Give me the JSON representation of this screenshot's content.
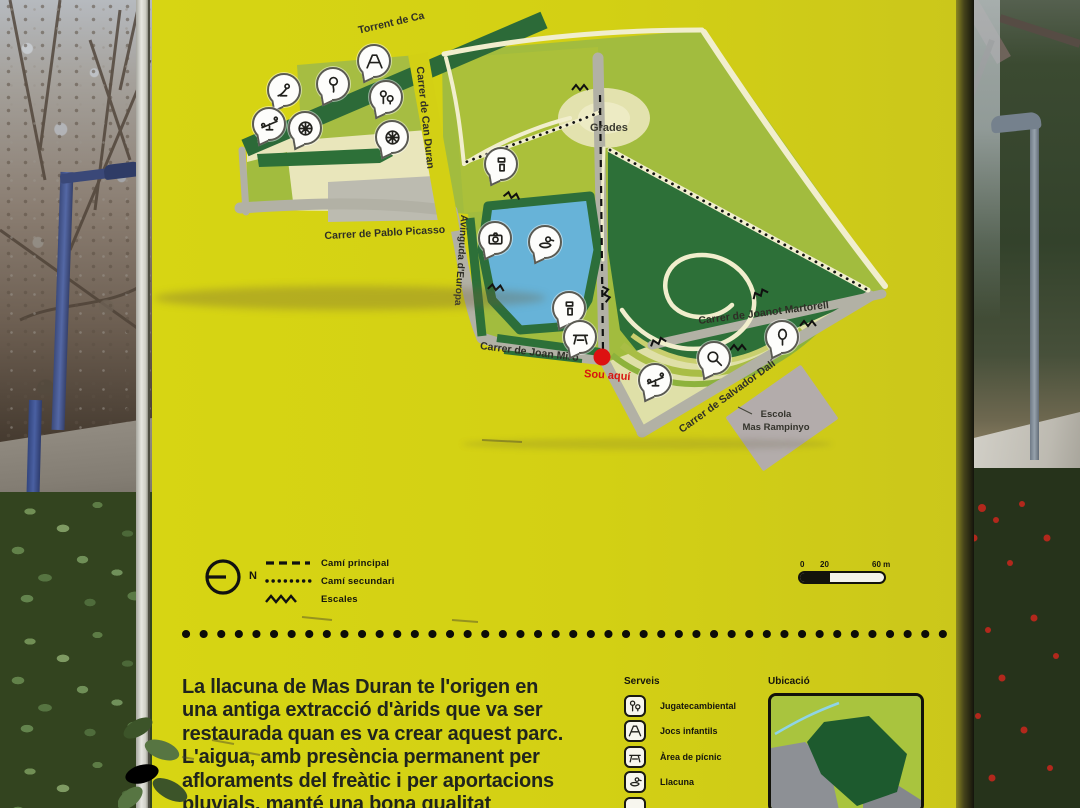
{
  "scene": {
    "description": "Photograph of a yellow park information panel (llacuna de Mas Duran) standing on a path between bare winter trees, lamp posts and bushes with red berries"
  },
  "colors": {
    "sign_yellow": "#d3d014",
    "map_light_green": "#a2bc3e",
    "map_dark_green": "#2d7038",
    "lake_blue": "#67b3d8",
    "path_cream": "#f1eecd",
    "street_gray": "#b2b1a5",
    "you_are_here_red": "#dd1111",
    "label_ink": "#2e2e26"
  },
  "sign": {
    "map": {
      "labels": {
        "torrent": "Torrent de Ca",
        "can_duran": "Carrer de Can Duran",
        "pablo_picasso": "Carrer de Pablo Picasso",
        "avinguda_europa": "Avinguda d'Europa",
        "grades": "Grades",
        "joanot_martorell": "Carrer de Joanot Martorell",
        "joan_miro": "Carrer de Joan Miró",
        "salvador_dali": "Carrer de Salvador Dalí",
        "escola_line1": "Escola",
        "escola_line2": "Mas Rampinyo",
        "you_are_here": "Sou aquí"
      },
      "markers": [
        {
          "icon": "bird-icon",
          "x": 132,
          "y": 90
        },
        {
          "icon": "swings-icon",
          "x": 222,
          "y": 61
        },
        {
          "icon": "balloon-icon",
          "x": 181,
          "y": 84
        },
        {
          "icon": "jugateca-icon",
          "x": 234,
          "y": 97
        },
        {
          "icon": "seesaw-icon",
          "x": 117,
          "y": 124
        },
        {
          "icon": "wheel-icon",
          "x": 153,
          "y": 128
        },
        {
          "icon": "wheel-icon",
          "x": 240,
          "y": 137
        },
        {
          "icon": "drink-icon",
          "x": 349,
          "y": 164
        },
        {
          "icon": "camera-icon",
          "x": 343,
          "y": 238
        },
        {
          "icon": "duck-icon",
          "x": 393,
          "y": 242
        },
        {
          "icon": "drink-icon",
          "x": 417,
          "y": 308
        },
        {
          "icon": "picnic-icon",
          "x": 428,
          "y": 337
        },
        {
          "icon": "seesaw-icon",
          "x": 503,
          "y": 380
        },
        {
          "icon": "magnifier-icon",
          "x": 562,
          "y": 358
        },
        {
          "icon": "racket-icon",
          "x": 630,
          "y": 337
        }
      ]
    },
    "legend": {
      "north": "N",
      "items": [
        {
          "label": "Camí principal"
        },
        {
          "label": "Camí secundari"
        },
        {
          "label": "Escales"
        }
      ],
      "scale_ticks": [
        "0",
        "20",
        "60 m"
      ]
    },
    "intro": {
      "lines": [
        "La llacuna de Mas Duran te l'origen en",
        "una antiga extracció d'àrids que va ser",
        "restaurada quan es va crear aquest parc.",
        "L'aigua, amb presència permanent per",
        "afloraments del freàtic i per aportacions",
        "pluvials, manté una bona qualitat"
      ]
    },
    "serveis": {
      "title": "Serveis",
      "items": [
        {
          "icon": "jugateca-icon",
          "label": "Jugatecambiental"
        },
        {
          "icon": "swings-icon",
          "label": "Jocs infantils"
        },
        {
          "icon": "picnic-icon",
          "label": "Àrea de pícnic"
        },
        {
          "icon": "duck-icon",
          "label": "Llacuna"
        }
      ]
    },
    "ubicacio": {
      "title": "Ubicació"
    }
  }
}
